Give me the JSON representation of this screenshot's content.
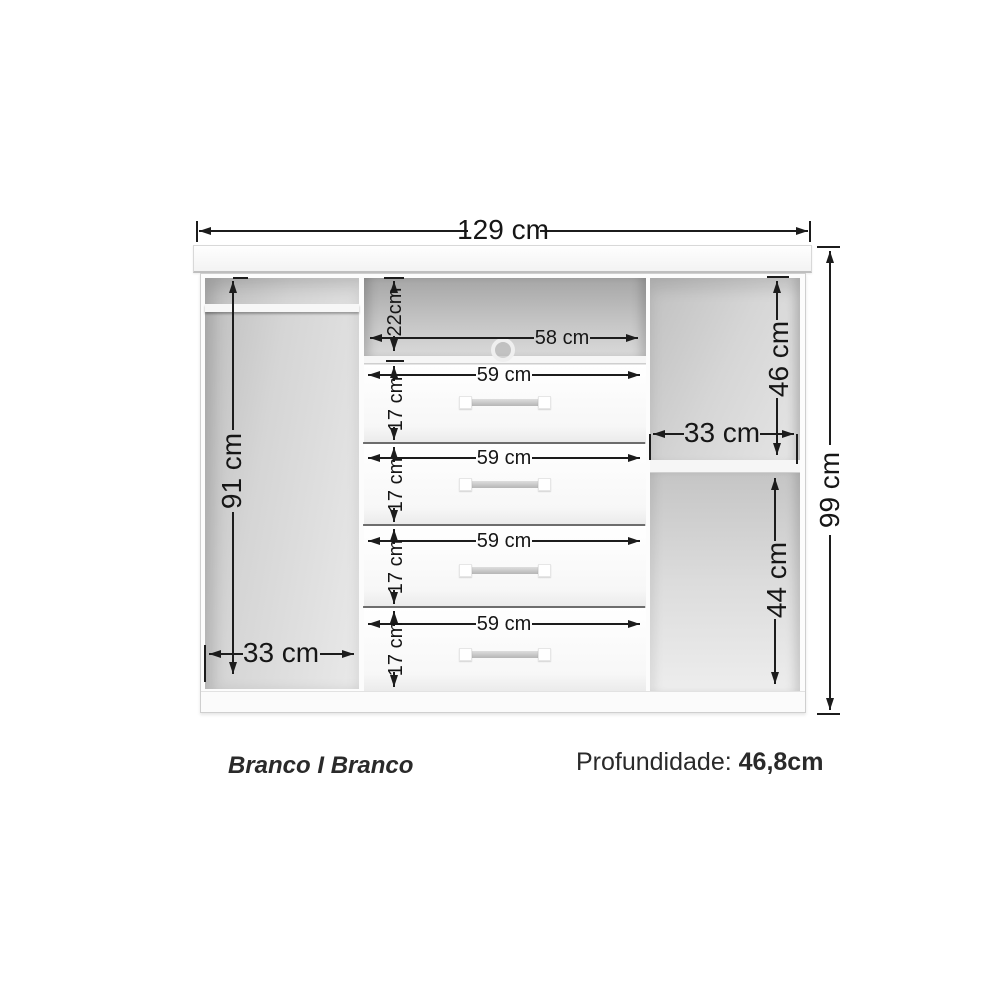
{
  "diagram": {
    "dims": {
      "overall_width": "129 cm",
      "overall_height": "99 cm",
      "left_height": "91 cm",
      "left_width": "33 cm",
      "niche_height": "22cm",
      "niche_width": "58 cm",
      "right_top_height": "46 cm",
      "right_width": "33 cm",
      "right_bottom_height": "44 cm"
    },
    "drawers": [
      {
        "width": "59 cm",
        "height": "17 cm"
      },
      {
        "width": "59 cm",
        "height": "17 cm"
      },
      {
        "width": "59 cm",
        "height": "17 cm"
      },
      {
        "width": "59 cm",
        "height": "17 cm"
      }
    ],
    "footer": {
      "finish": "Branco I Branco",
      "depth_label": "Profundidade:",
      "depth_value": "46,8cm"
    },
    "colors": {
      "line": "#1c1c1c",
      "interior_gray": "#c8c8c8",
      "accent_white": "#ffffff"
    }
  }
}
